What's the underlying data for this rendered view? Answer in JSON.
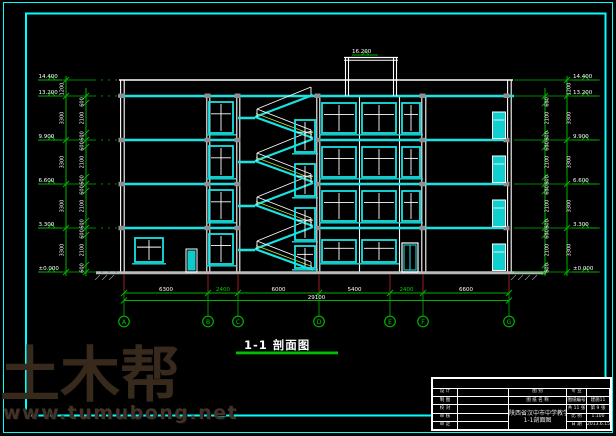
{
  "drawing_title": {
    "text": "1-1 剖面图"
  },
  "watermark": {
    "brand": "土木帮",
    "url": "www.tumubong.net"
  },
  "colors": {
    "line_cyan": "#17e3e3",
    "frame_cyan": "#00ffff",
    "dim_green": "#00b400",
    "axis_red": "#8b1e1e",
    "text_white": "#ffffff",
    "watermark_brown": "#372a1d"
  },
  "grid": {
    "bubbles": [
      "A",
      "B",
      "C",
      "D",
      "E",
      "F",
      "G"
    ],
    "dims": [
      "6300",
      "2400",
      "6000",
      "5400",
      "2400",
      "6600"
    ],
    "overall": "29100"
  },
  "elevations": {
    "values": [
      "14.400",
      "13.200",
      "9.900",
      "6.600",
      "3.300",
      "±0.000"
    ],
    "bulkhead": "16.200"
  },
  "vdims": {
    "parapet": "1200",
    "story": "3300",
    "sill": "600",
    "window": "2100",
    "head": "600"
  },
  "title_block": {
    "header_row1": "图 别",
    "header_row2": "图 纸 名 称",
    "project": "陕西省汉中市中学教学楼",
    "sheet": "1-1剖面图",
    "left_rows": [
      {
        "label": "设 计",
        "value": ""
      },
      {
        "label": "制 图",
        "value": ""
      },
      {
        "label": "校 对",
        "value": ""
      },
      {
        "label": "审 核",
        "value": ""
      },
      {
        "label": "审 定",
        "value": ""
      }
    ],
    "right_rows": [
      {
        "label": "专 业",
        "value": ""
      },
      {
        "label": "图纸编号",
        "value": "建施11"
      },
      {
        "label": "共 11 张",
        "value": "第 9 张"
      },
      {
        "label": "比 例",
        "value": "1:100"
      },
      {
        "label": "日 期",
        "value": "2013.6.15"
      }
    ]
  }
}
